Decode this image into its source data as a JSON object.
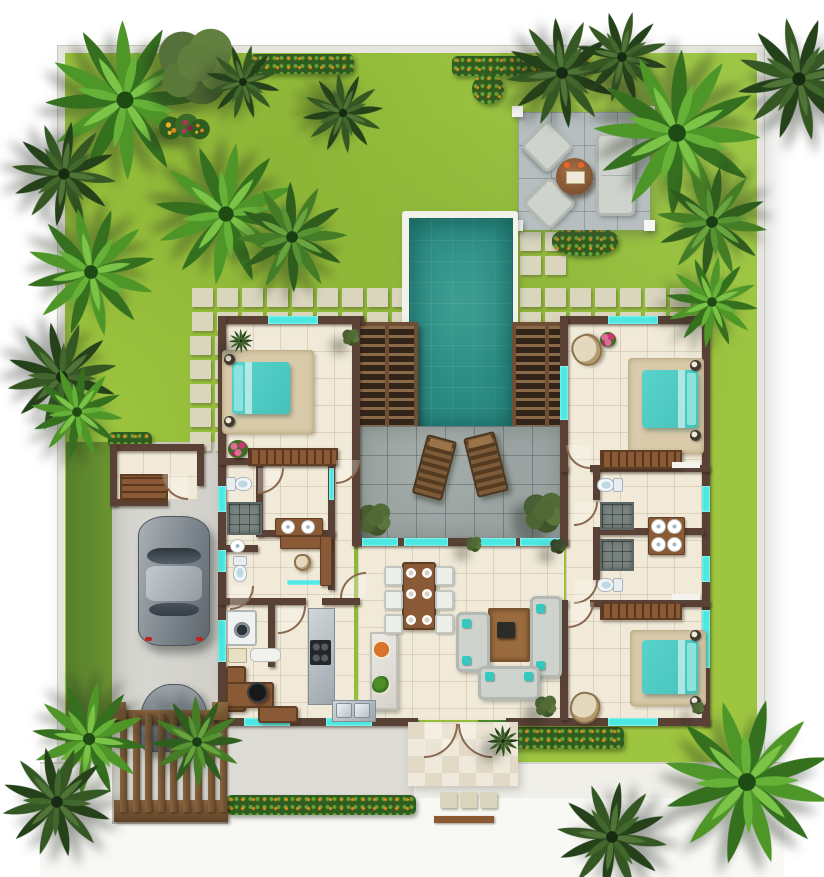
{
  "palette": {
    "lawn": "#9dc53f",
    "lawn_dark": "#7fae2f",
    "lawn_shade": "#567f2b",
    "wall": "#5a4136",
    "floor": "#f1ead9",
    "terrace": "#9aa3a1",
    "patio": "#b6bec0",
    "pool_water": "#2b8d84",
    "pool_deep": "#1c6b63",
    "coping": "#f2f1ea",
    "window_glass": "#4ae8e2",
    "paver": "#dad6be",
    "concrete": "#dcdbd5",
    "wood": "#8a5a36",
    "louver_deck": "#33241a",
    "bed_linen": "#59d3cc",
    "rug": "#d9cbaa",
    "sofa": "#cfd3cd",
    "hedge": "#2f5c1f",
    "hedge_flowers": "#e0891c",
    "car_body": "#8d959c",
    "gate_wood": "#8a6540"
  },
  "scene": {
    "type": "villa-floor-plan-top-view",
    "outdoor_elements": [
      "lawn-garden",
      "palm-trees",
      "flower-hedges",
      "swimming-pool",
      "pool-louver-decks",
      "sun-terrace",
      "lounge-chairs",
      "outdoor-patio-lounge",
      "stepping-stone-paths",
      "driveway",
      "wooden-gate",
      "entrance-porch",
      "sidewalk"
    ],
    "indoor_elements": [
      "bedroom-1",
      "bedroom-2",
      "bedroom-3",
      "bathrooms",
      "walk-in-closet",
      "kitchen",
      "dining-area",
      "living-room",
      "laundry",
      "study-desk",
      "storage-room",
      "garage-cars"
    ],
    "counts": {
      "bedrooms": 3,
      "beds": 3,
      "toilets": 4,
      "cars": 2,
      "sofas": 3,
      "lounge_chairs_terrace": 2,
      "patio_armchairs": 2
    }
  }
}
